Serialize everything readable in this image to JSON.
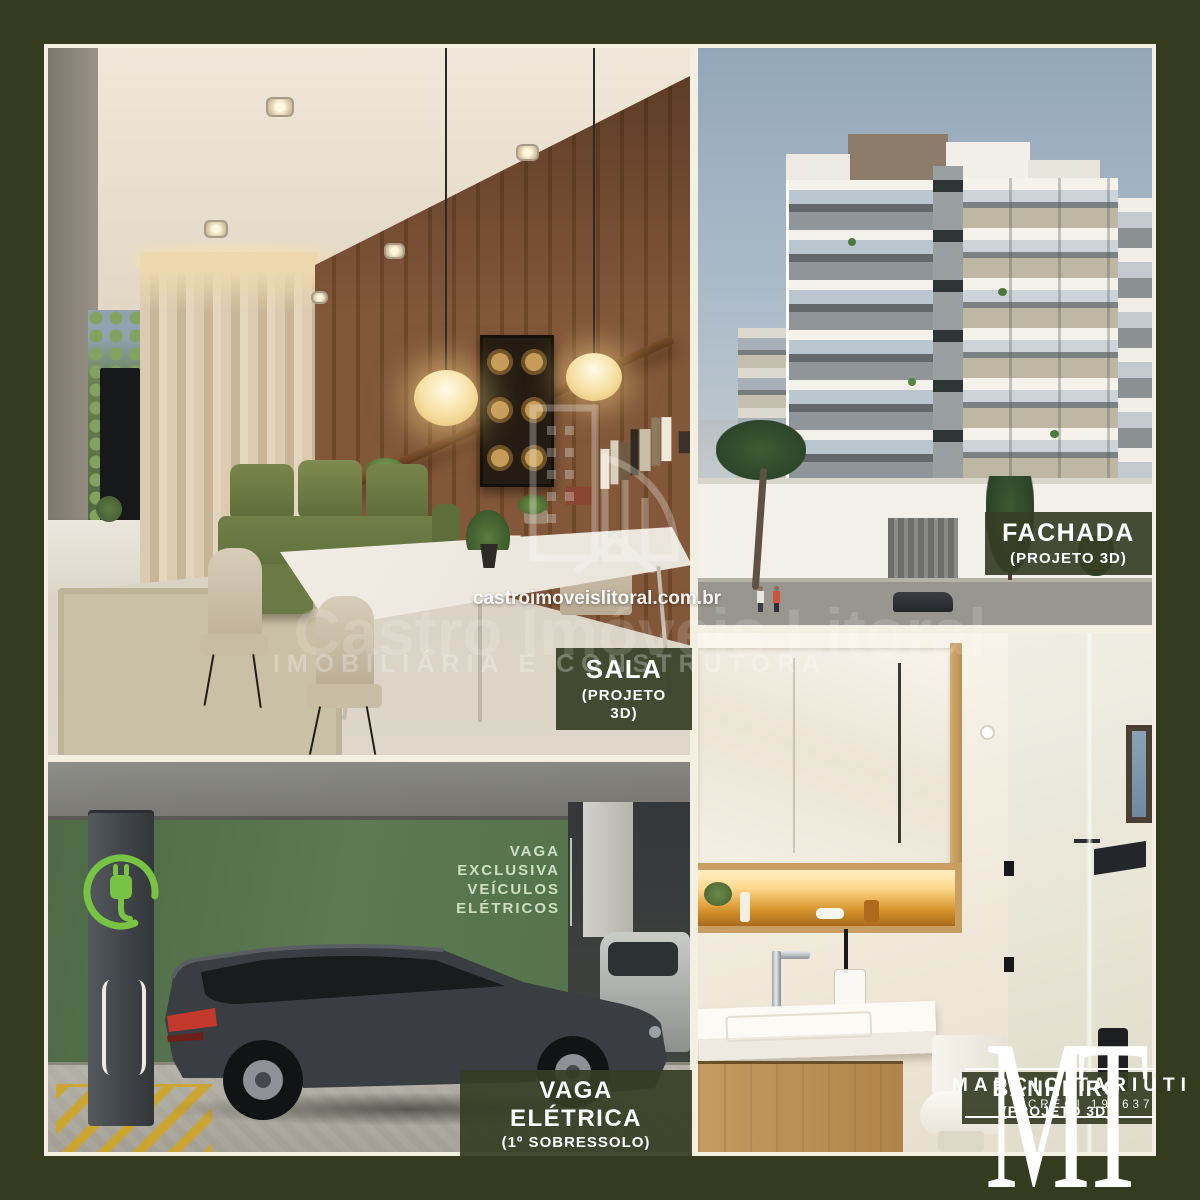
{
  "frame": {
    "border_color": "#f3f0e1",
    "background_olive": "#343b1e"
  },
  "labels": {
    "sala": {
      "title": "SALA",
      "subtitle": "(PROJETO 3D)"
    },
    "fachada": {
      "title": "FACHADA",
      "subtitle": "(PROJETO 3D)"
    },
    "banheiro": {
      "title": "BANHEIRO",
      "subtitle": "(PROJETO 3D)"
    },
    "vaga": {
      "title": "VAGA ELÉTRICA",
      "subtitle": "(1º SOBRESSOLO)"
    }
  },
  "garage_sign": {
    "line1": "VAGA",
    "line2": "EXCLUSIVA",
    "line3": "VEÍCULOS",
    "line4": "ELÉTRICOS"
  },
  "watermark": {
    "url": "castroimoveislitoral.com.br",
    "brand": "Castro Imóveis Litoral",
    "tagline": "IMOBILIÁRIA E CONSTRUTORA"
  },
  "broker": {
    "monogram_m": "M",
    "monogram_t": "T",
    "name": "MARCIO TARIUTI",
    "creci": "CRECI 195637"
  },
  "colors": {
    "ev_green": "#79c344",
    "label_bg": "rgba(54,61,36,0.92)",
    "sky_top": "#93a7bb",
    "garage_wall": "#557250",
    "wood": "#7d5334",
    "frame_line": "#f3f0e1"
  }
}
